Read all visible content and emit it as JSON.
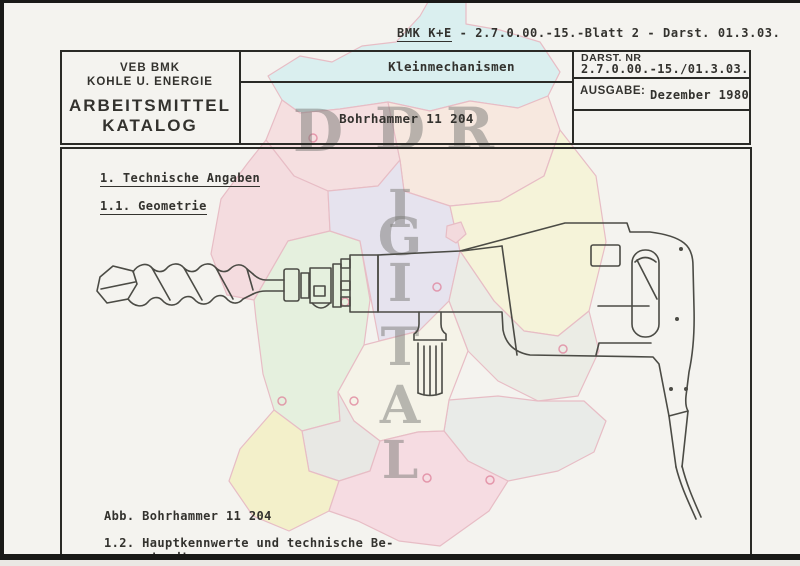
{
  "document": {
    "ref_line": {
      "code": "BMK K+E",
      "rest": " - 2.7.0.00.-15.-Blatt 2 - Darst. 01.3.03."
    },
    "header": {
      "org": [
        "VEB BMK",
        "KOHLE U. ENERGIE"
      ],
      "catalog": [
        "ARBEITSMITTEL",
        "KATALOG"
      ],
      "category": "Kleinmechanismen",
      "item_title": "Bohrhammer 11 204",
      "darst": {
        "label": "DARST. NR",
        "value": "2.7.0.00.-15./01.3.03."
      },
      "ausgabe": {
        "label": "AUSGABE:",
        "value": "Dezember 1980"
      }
    },
    "body": {
      "section_1": "1. Technische Angaben",
      "section_1_1": "1.1. Geometrie",
      "figure_caption": "Abb. Bohrhammer 11 204",
      "section_1_2_line1": "1.2. Hauptkennwerte und technische Be-",
      "section_1_2_line2": "schreibung"
    }
  },
  "watermark": {
    "row_letters": [
      "D",
      "D",
      "R"
    ],
    "column_letters": [
      "I",
      "G",
      "I",
      "T",
      "A",
      "L"
    ]
  },
  "colors": {
    "paper": "#f4f3ef",
    "text": "#33322e",
    "border-dark": "#2a2a26",
    "ink": "#4b4b45",
    "scan-edge": "#191917",
    "wm-letter": "#7b7b78",
    "map-stroke": "#dd8ca0",
    "ring": "#df8099",
    "map-cyan": "#c3ecef",
    "map-pink1": "#f7cdd4",
    "map-peach": "#fadfd2",
    "map-pink2": "#f5c8d2",
    "map-lavender": "#dbd6ee",
    "map-yellow1": "#f7f3c6",
    "map-green": "#d8efcf",
    "map-gray1": "#e3e7dc",
    "map-gray2": "#dfe4e3",
    "map-cream": "#f6f3e3",
    "map-gray3": "#dedfda",
    "map-yellow2": "#f3efa9",
    "map-pink3": "#f8c8d7",
    "map-pink-small": "#f3c4cd"
  }
}
